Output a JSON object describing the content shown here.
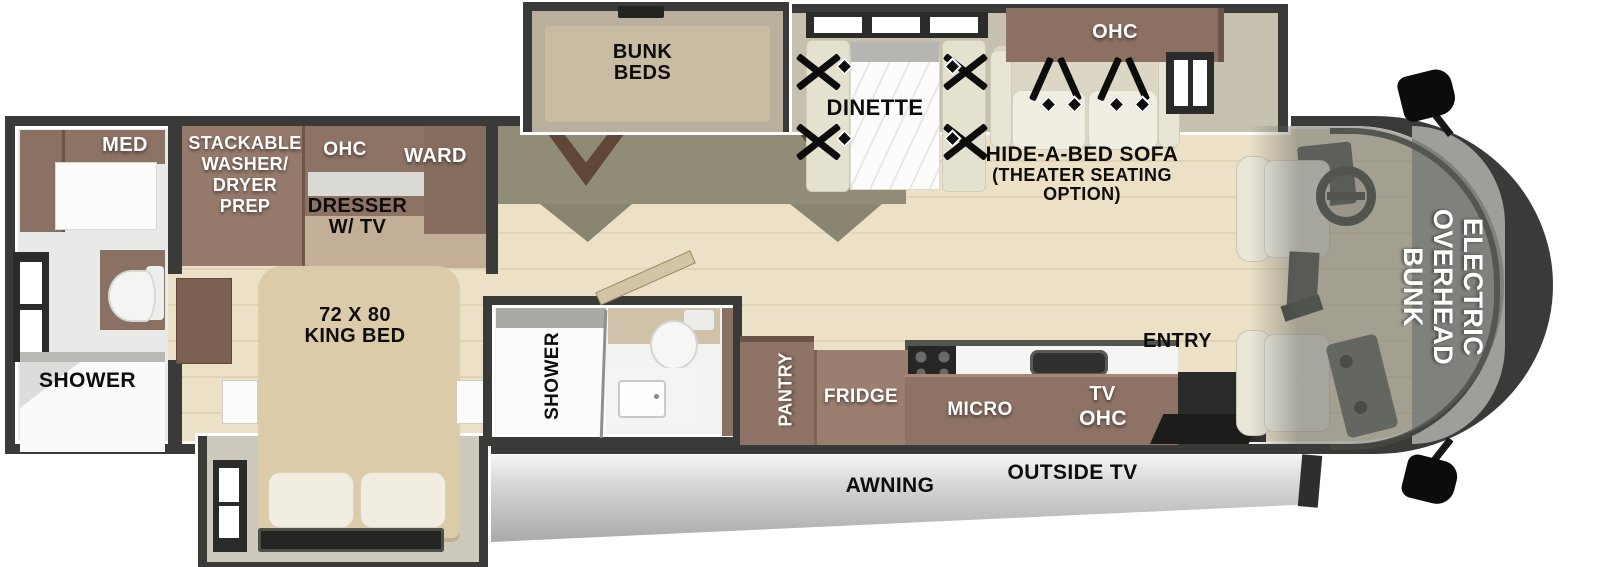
{
  "diagram": {
    "type": "rv-floorplan-top-view",
    "labels": {
      "bunk_beds": [
        "BUNK",
        "BEDS"
      ],
      "dinette": "DINETTE",
      "ohc_sofa": "OHC",
      "hide_a_bed": [
        "HIDE-A-BED SOFA",
        "(THEATER SEATING",
        "OPTION)"
      ],
      "electric_overhead_bunk": [
        "ELECTRIC",
        "OVERHEAD",
        "BUNK"
      ],
      "med": "MED",
      "stackable": [
        "STACKABLE",
        "WASHER/",
        "DRYER",
        "PREP"
      ],
      "ohc_bedroom": "OHC",
      "ward": "WARD",
      "dresser_tv": [
        "DRESSER",
        "W/ TV"
      ],
      "king_bed": [
        "72 X 80",
        "KING BED"
      ],
      "shower_rear": "SHOWER",
      "shower_mid": "SHOWER",
      "pantry": "PANTRY",
      "fridge": "FRIDGE",
      "micro": "MICRO",
      "tv": "TV",
      "ohc_kitchen": "OHC",
      "entry": "ENTRY",
      "awning": "AWNING",
      "outside_tv": "OUTSIDE TV"
    },
    "colors": {
      "wall": "#3a3a38",
      "floor_wood": "#ebdfc4",
      "cabinet_brown": "#8b7164",
      "slide_gray": "#c6c0ae",
      "bed_tan": "#dbcba8",
      "upholstery_cream": "#efece0",
      "awning_gray": "#d8d8d8",
      "label_white": "#ffffff",
      "label_black": "#0d0d0d"
    }
  }
}
